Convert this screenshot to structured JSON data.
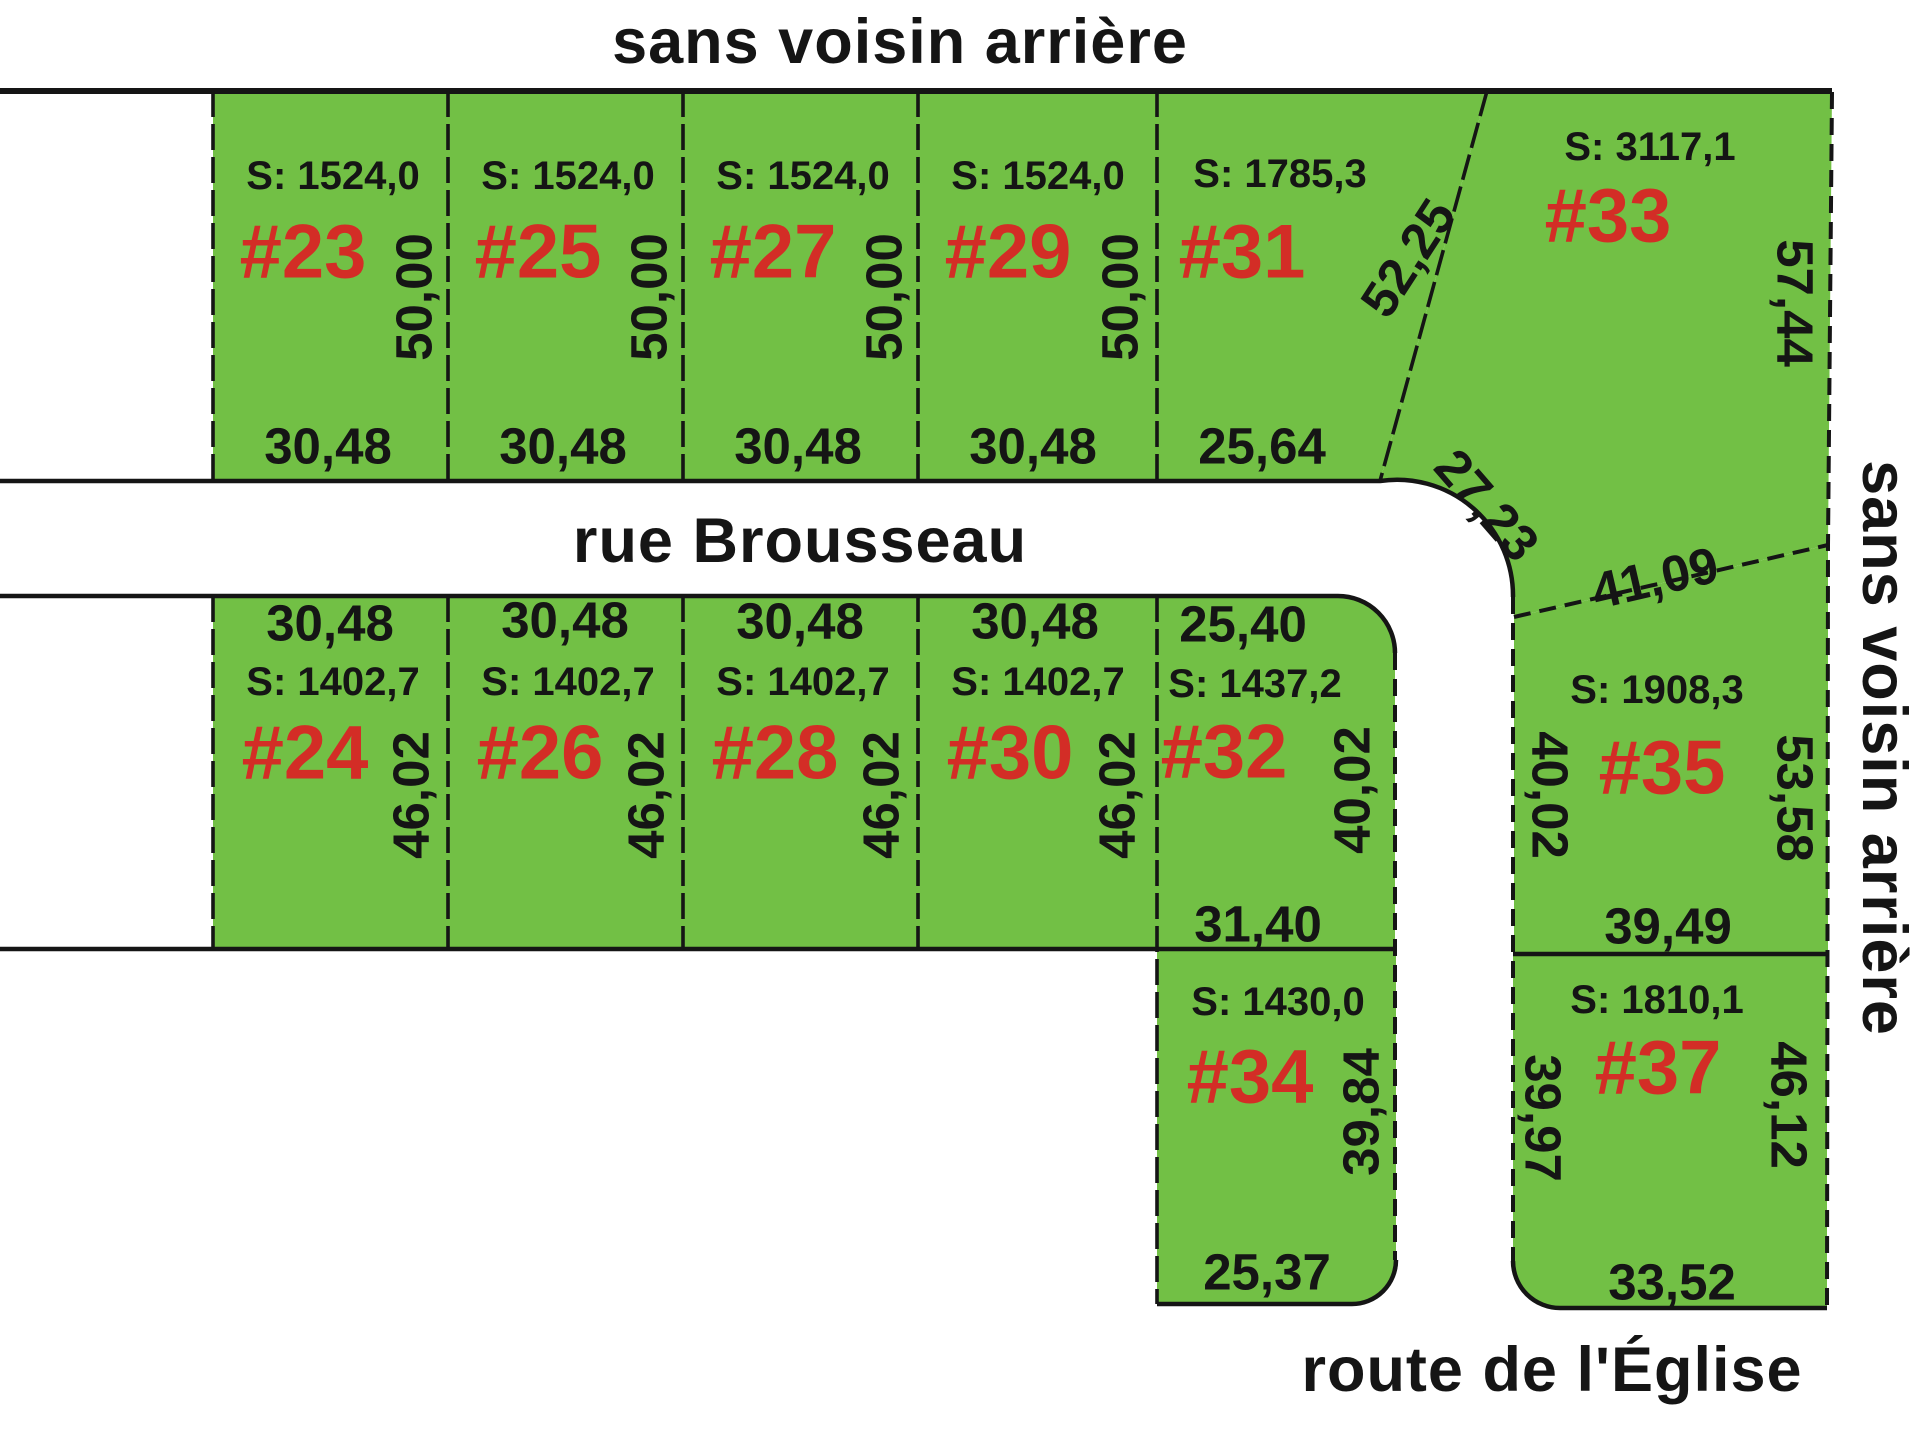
{
  "titles": {
    "top": "sans voisin arrière",
    "right": "sans voisin arrière",
    "street": "rue Brousseau",
    "route": "route de l'Église"
  },
  "colors": {
    "lot_fill": "#72c045",
    "lot_number_red": "#d32d26",
    "line_black": "#151515",
    "background": "#ffffff"
  },
  "lots": [
    {
      "number": "#23",
      "surface": "S: 1524,0",
      "frontage": "30,48",
      "depth": "50,00"
    },
    {
      "number": "#25",
      "surface": "S: 1524,0",
      "frontage": "30,48",
      "depth": "50,00"
    },
    {
      "number": "#27",
      "surface": "S: 1524,0",
      "frontage": "30,48",
      "depth": "50,00"
    },
    {
      "number": "#29",
      "surface": "S: 1524,0",
      "frontage": "30,48",
      "depth": "50,00"
    },
    {
      "number": "#31",
      "surface": "S: 1785,3",
      "frontage": "25,64",
      "diagonal": "52,25"
    },
    {
      "number": "#33",
      "surface": "S: 3117,1",
      "east": "57,44",
      "curve": "27,23",
      "south": "41,09"
    },
    {
      "number": "#24",
      "surface": "S: 1402,7",
      "frontage": "30,48",
      "depth": "46,02"
    },
    {
      "number": "#26",
      "surface": "S: 1402,7",
      "frontage": "30,48",
      "depth": "46,02"
    },
    {
      "number": "#28",
      "surface": "S: 1402,7",
      "frontage": "30,48",
      "depth": "46,02"
    },
    {
      "number": "#30",
      "surface": "S: 1402,7",
      "frontage": "30,48",
      "depth": "46,02"
    },
    {
      "number": "#32",
      "surface": "S: 1437,2",
      "frontage": "25,40",
      "depth": "40,02",
      "rear": "31,40"
    },
    {
      "number": "#35",
      "surface": "S: 1908,3",
      "west": "40,02",
      "east": "53,58",
      "south": "39,49"
    },
    {
      "number": "#34",
      "surface": "S: 1430,0",
      "east": "39,84",
      "south": "25,37"
    },
    {
      "number": "#37",
      "surface": "S: 1810,1",
      "west": "39,97",
      "east": "46,12",
      "south": "33,52"
    }
  ]
}
